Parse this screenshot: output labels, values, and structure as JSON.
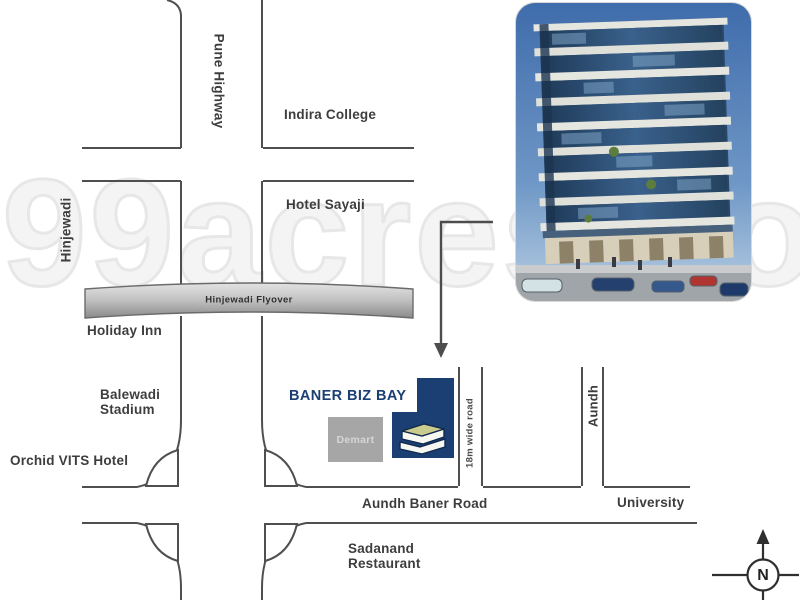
{
  "map": {
    "title": "Baner Biz Bay location map",
    "labels": {
      "pune_highway": "Pune Highway",
      "hinjewadi": "Hinjewadi",
      "indira_college": "Indira College",
      "hotel_sayaji": "Hotel Sayaji",
      "hinjewadi_flyover": "Hinjewadi Flyover",
      "holiday_inn": "Holiday Inn",
      "balewadi_stadium": {
        "line1": "Balewadi",
        "line2": "Stadium"
      },
      "orchid_vits_hotel": "Orchid VITS Hotel",
      "road_18m": "18m wide road",
      "aundh": "Aundh",
      "aundh_baner_road": "Aundh Baner Road",
      "university": "University",
      "sadanand_restaurant": {
        "line1": "Sadanand",
        "line2": "Restaurant"
      }
    },
    "project": {
      "name": "BANER BIZ BAY",
      "landmark_store": "Demart"
    },
    "compass": {
      "north": "N"
    },
    "watermark": "99acres.com",
    "icons": {
      "location_arrow": "elbow-down-arrow",
      "compass": "compass-north-rose",
      "logo_icon": "stacked-books"
    },
    "colors": {
      "brand_navy": "#1B3F72",
      "road_outline_gray": "#4F4F4F",
      "landmark_box_gray": "#A6A6A6",
      "flyover_gray": "#B5B5B5",
      "watermark_gray": "#E7E7E7"
    }
  }
}
